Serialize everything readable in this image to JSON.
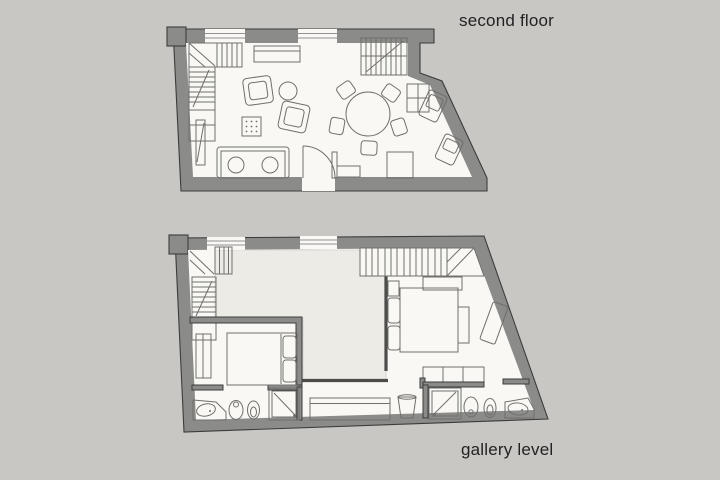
{
  "page": {
    "background": "#c8c7c4"
  },
  "colors": {
    "background": "#c8c7c4",
    "wall_fill": "#8b8b89",
    "wall_outline": "#3c3c3c",
    "floor": "#f9f8f5",
    "void_fill": "#edebe6",
    "furniture_line": "#706f6c",
    "text": "#222222"
  },
  "plans": {
    "second_floor": {
      "label": "second floor",
      "features": [
        "staircase",
        "armchairs",
        "round side table",
        "dotted ottoman",
        "sofa",
        "round dining table with five chairs",
        "kitchen counter along slanted wall",
        "entry door with swing",
        "upper staircase",
        "cabinets"
      ]
    },
    "gallery_level": {
      "label": "gallery level",
      "features": [
        "staircase",
        "open void over living room",
        "bedroom with double bed and wardrobe",
        "second bedroom with double bed and bench",
        "two bathrooms with shower, toilet, bidet and sink",
        "hall wardrobes",
        "laundry basket"
      ]
    }
  }
}
